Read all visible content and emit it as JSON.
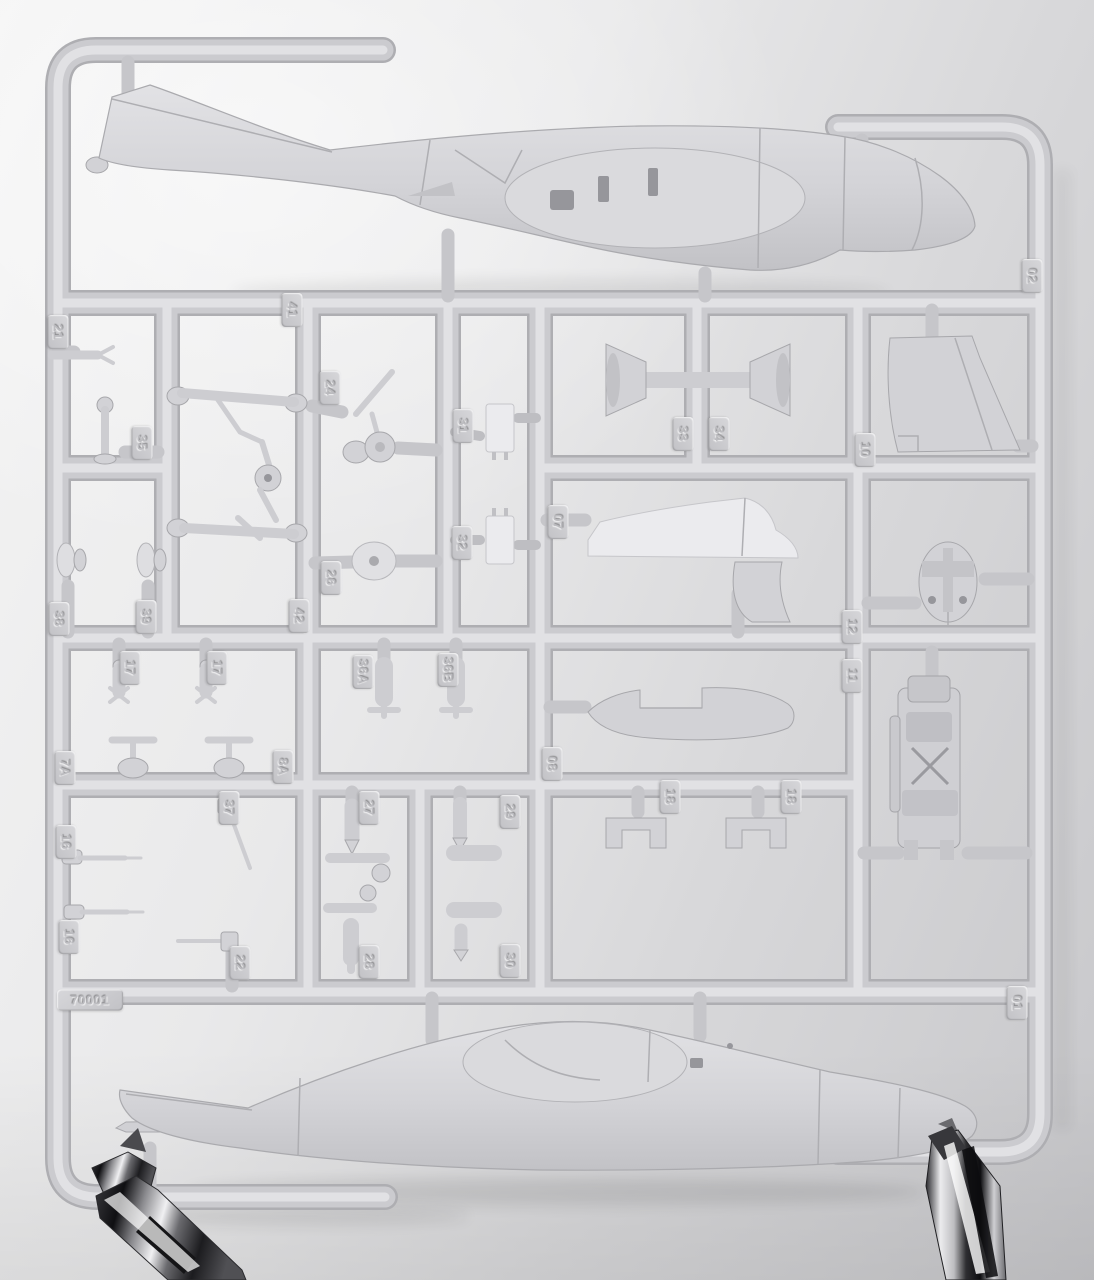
{
  "sprue": {
    "kit_number": "70001",
    "part_tags": [
      {
        "label": "02"
      },
      {
        "label": "21"
      },
      {
        "label": "41"
      },
      {
        "label": "24"
      },
      {
        "label": "31"
      },
      {
        "label": "33"
      },
      {
        "label": "34"
      },
      {
        "label": "10"
      },
      {
        "label": "35"
      },
      {
        "label": "07"
      },
      {
        "label": "32"
      },
      {
        "label": "26"
      },
      {
        "label": "38"
      },
      {
        "label": "39"
      },
      {
        "label": "42"
      },
      {
        "label": "12"
      },
      {
        "label": "17"
      },
      {
        "label": "17"
      },
      {
        "label": "36A"
      },
      {
        "label": "36B"
      },
      {
        "label": "11"
      },
      {
        "label": "7A"
      },
      {
        "label": "8A"
      },
      {
        "label": "08"
      },
      {
        "label": "37"
      },
      {
        "label": "27"
      },
      {
        "label": "29"
      },
      {
        "label": "18"
      },
      {
        "label": "18"
      },
      {
        "label": "16"
      },
      {
        "label": "16"
      },
      {
        "label": "22"
      },
      {
        "label": "28"
      },
      {
        "label": "30"
      },
      {
        "label": "70001"
      },
      {
        "label": "01"
      }
    ]
  },
  "colors": {
    "plastic_base": "#d2d2d6",
    "plastic_highlight": "#e3e3e6",
    "plastic_shadow": "#aeaeb2",
    "clear_part": "#ebebee",
    "background_top_left": "#f4f4f4",
    "background_bottom_right": "#c7c7ca",
    "chrome_dark": "#1e1e21",
    "chrome_light": "#f2f2f4"
  }
}
